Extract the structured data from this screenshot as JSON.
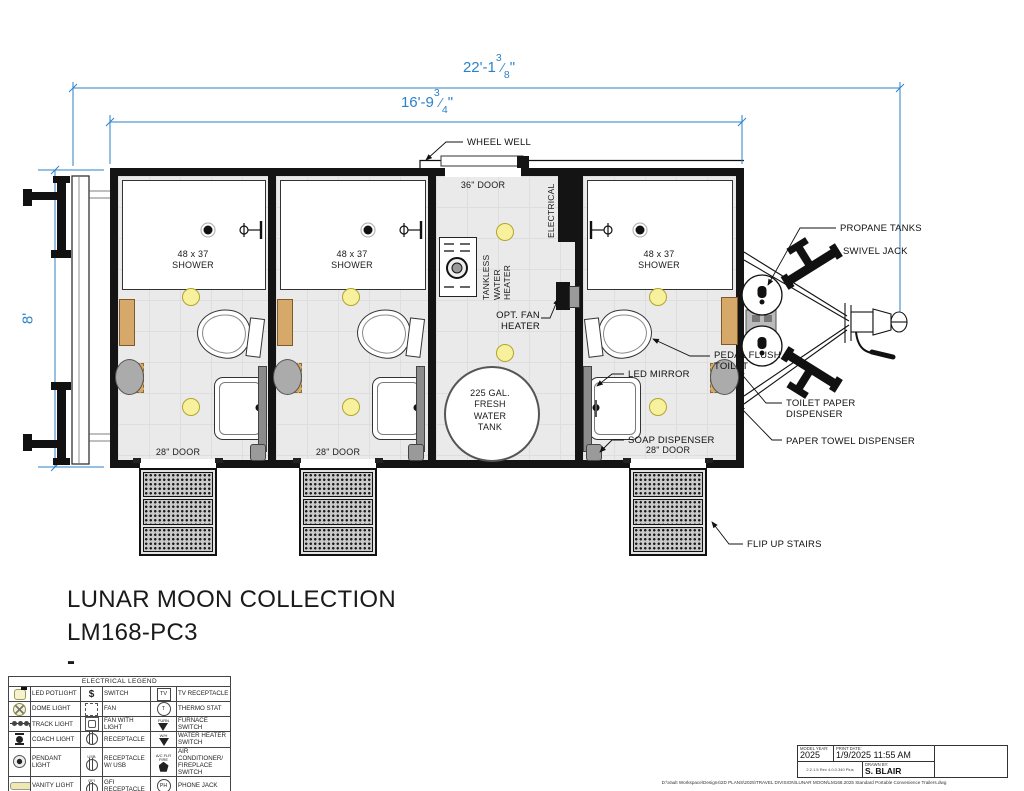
{
  "dimensions": {
    "slash": "⁄",
    "overall_length": {
      "whole": "22'-1",
      "numerator": "3",
      "denominator": "8",
      "unit": "\""
    },
    "box_length": {
      "whole": "16'-9",
      "numerator": "3",
      "denominator": "4",
      "unit": "\""
    },
    "body_width": "8'"
  },
  "plan_labels": {
    "wheel_well": "WHEEL WELL",
    "door_36": "36\" DOOR",
    "door_28": "28\" DOOR",
    "electrical": "ELECTRICAL",
    "tankless": "TANKLESS\nWATER\nHEATER",
    "opt_fan": "OPT. FAN\nHEATER",
    "water_tank": "225 GAL.\nFRESH\nWATER\nTANK",
    "shower": "48 x 37\nSHOWER",
    "pedal_flush": "PEDAL FLUSH\nTOILET",
    "led_mirror": "LED MIRROR",
    "soap": "SOAP DISPENSER",
    "toilet_paper": "TOILET PAPER\nDISPENSER",
    "paper_towel": "PAPER TOWEL DISPENSER",
    "propane": "PROPANE TANKS",
    "swivel": "SWIVEL JACK",
    "flip_stairs": "FLIP UP STAIRS"
  },
  "title": {
    "line1": "LUNAR MOON COLLECTION",
    "line2": "LM168-PC3",
    "line3": "-"
  },
  "legend": {
    "title": "ELECTRICAL LEGEND",
    "rows": [
      {
        "l1": "LED POTLIGHT",
        "s2": "$",
        "l2": "SWITCH",
        "s3": "TV",
        "l3": "TV RECEPTACLE"
      },
      {
        "l1": "DOME LIGHT",
        "l2": "FAN",
        "s3": "T",
        "l3": "THERMO STAT"
      },
      {
        "l1": "TRACK LIGHT",
        "l2": "FAN WITH LIGHT",
        "s3t": "FURN",
        "l3": "FURNACE SWITCH"
      },
      {
        "l1": "COACH LIGHT",
        "l2": "RECEPTACLE",
        "s3t": "W/H",
        "l3": "WATER HEATER\nSWITCH"
      },
      {
        "l1": "PENDANT LIGHT",
        "s2t": "USB",
        "l2": "RECEPTACLE\nW/ USB",
        "s3t": "A/C FLR FIRE",
        "l3": "AIR CONDITIONER/\nFIREPLACE SWITCH"
      },
      {
        "l1": "VANITY LIGHT",
        "s2t": "GFI",
        "l2": "GFI RECEPTACLE",
        "s3": "PH",
        "l3": "PHONE JACK"
      },
      {
        "l1": "READING LIGHT",
        "l2": "FLOOR RECEPTACLE",
        "s3": "SD",
        "l3": "SMOKE DETECTOR"
      }
    ]
  },
  "title_block": {
    "model_year_label": "MODEL YEAR:",
    "model_year": "2025",
    "print_date_label": "PRINT DATE:",
    "print_date": "1/9/2025 11:55 AM",
    "drawn_by_label": "DRAWN BY:",
    "drawn_by": "S. BLAIR",
    "version_note": "2.2.1.5 Rev 4.0.0.340 Plus",
    "file_path": "D:\\Vault Workspace\\Designs\\2D PLANS\\2025\\TRAVEL DIVISION\\LUNAR MOON\\LM168.2025 Standard Portable Convenience Trailers.dwg"
  }
}
